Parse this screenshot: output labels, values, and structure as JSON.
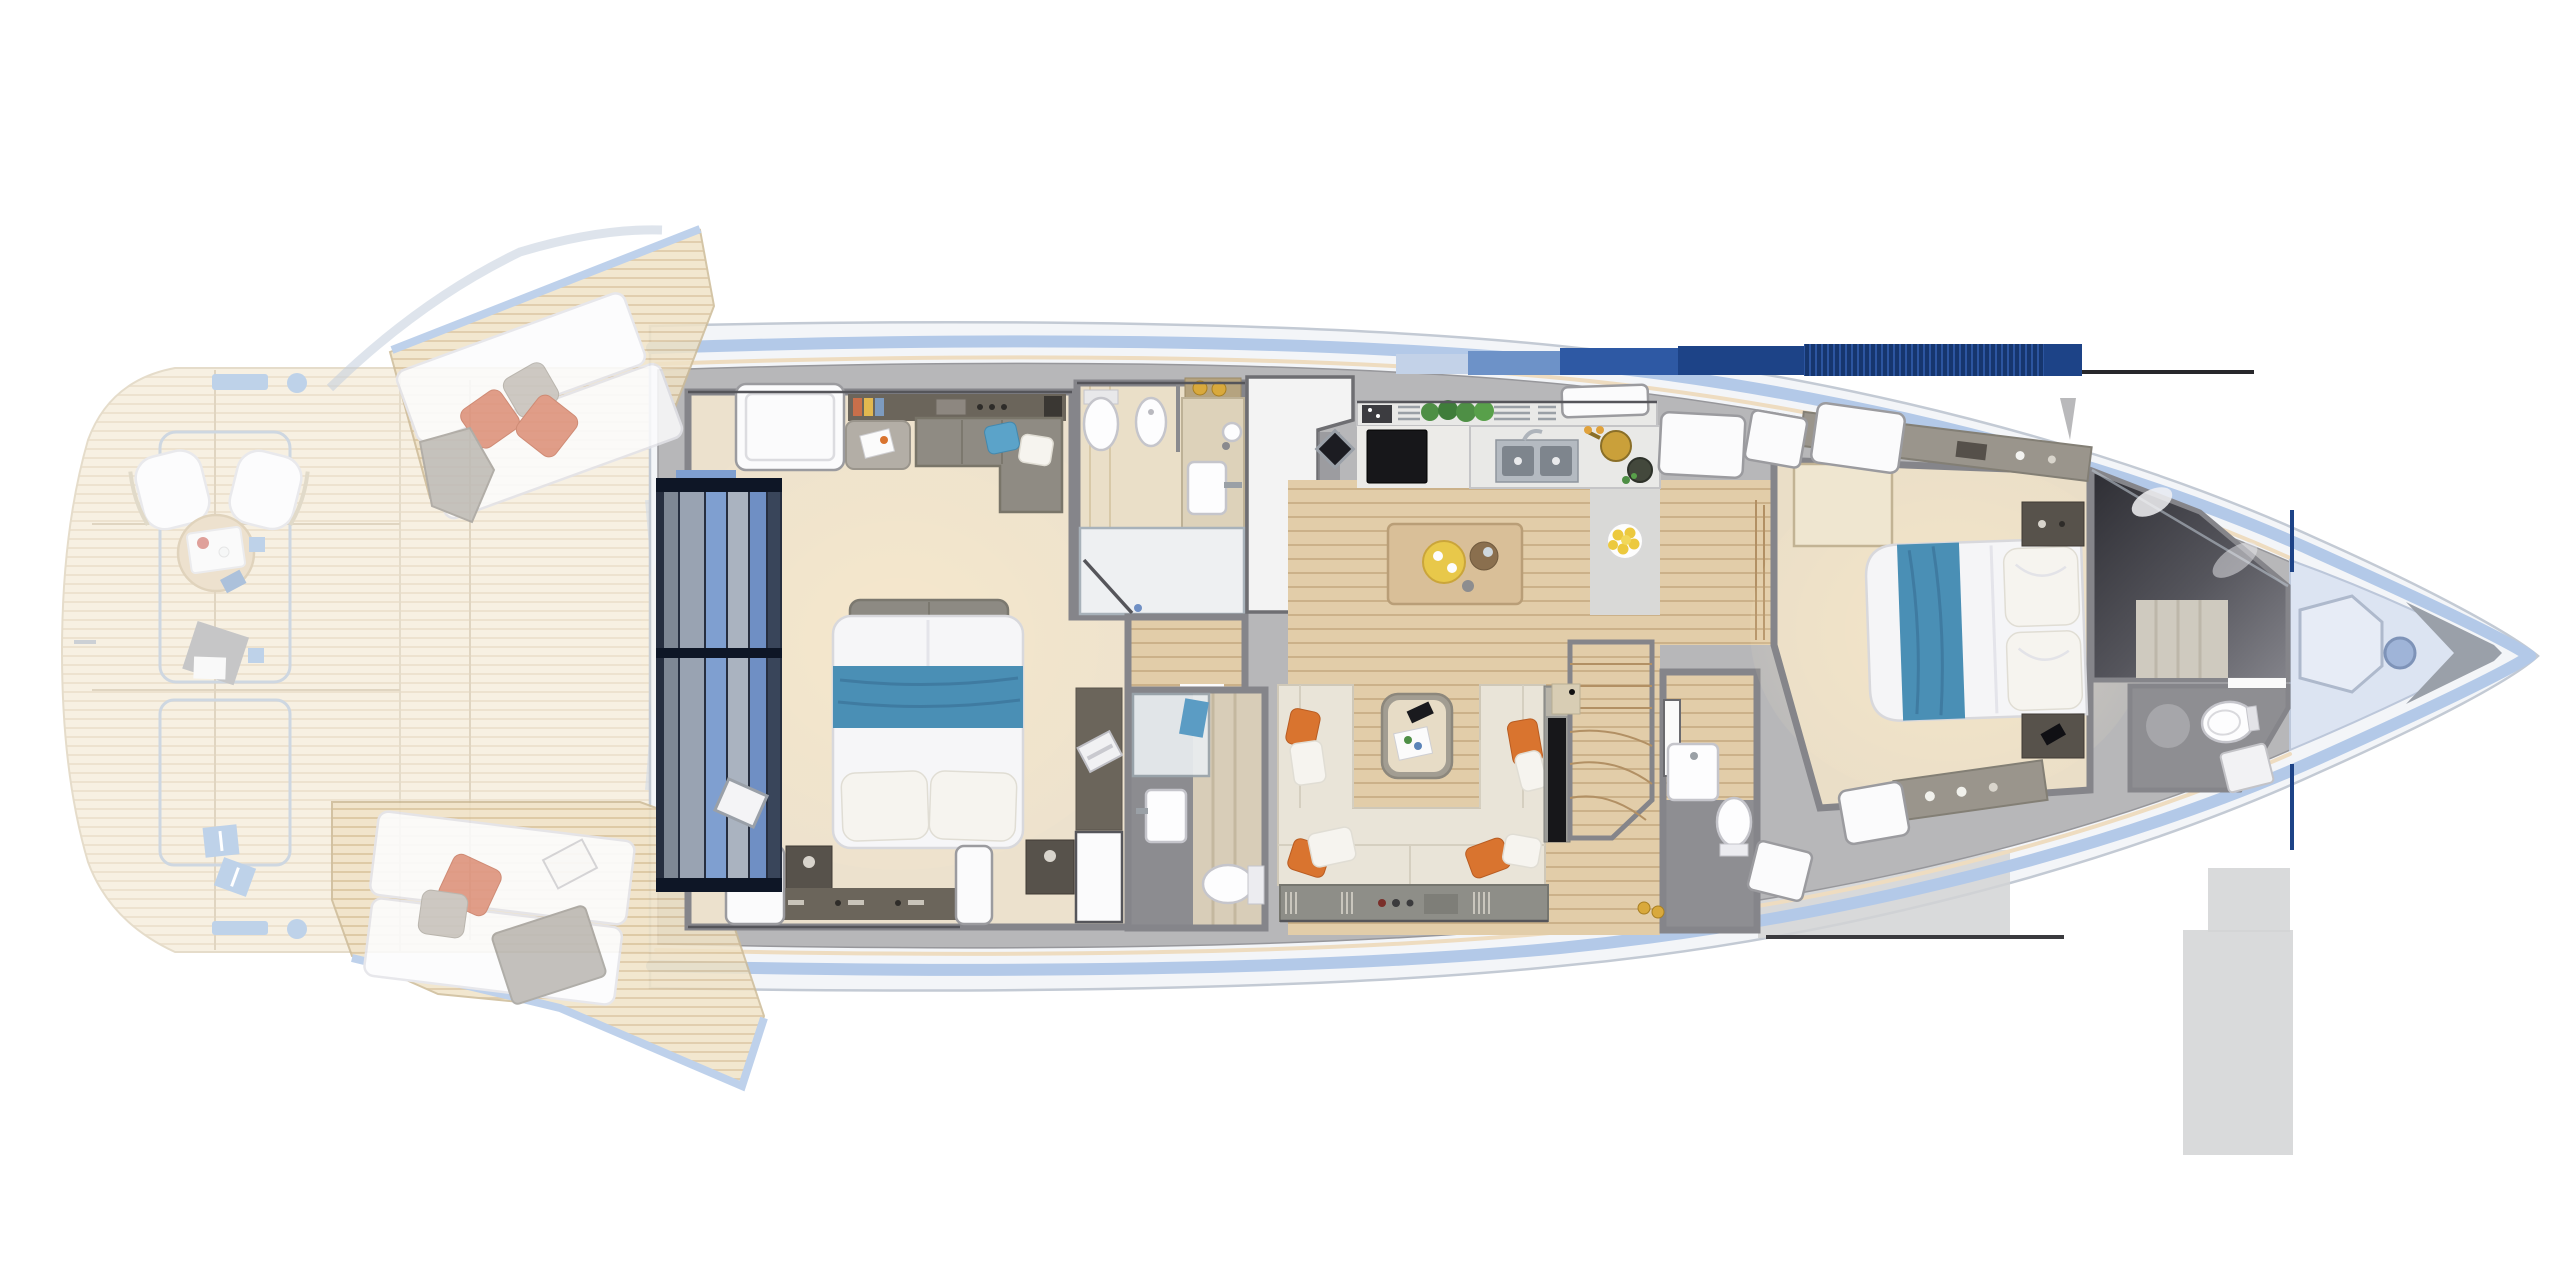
{
  "title": "Motor yacht deck plan — top-down interior rendering (no visible text in image)",
  "palette": {
    "hull": "#f3f5f8",
    "hullEdge": "#c3cad4",
    "stripe": "#b3c9e8",
    "warmLine": "#eedcc0",
    "deckGray": "#b7b7b9",
    "wallMid": "#85858a",
    "wallDark": "#55555a",
    "teak": "#f0e3c7",
    "teakLine": "#dcc6a0",
    "teakEdge": "#cdbb97",
    "wood": "#e2cda9",
    "woodLine": "#cbb189",
    "floorCream": "#ece1cd",
    "floorBath": "#eadfc8",
    "floorGrayDark": "#8e8e92",
    "floorGrayLight": "#d9d9d7",
    "navy": "#1d4387",
    "navyDark": "#16366e",
    "navyMid": "#2c55a0",
    "blueMid": "#6d92c8",
    "blueLight": "#c3d2e8",
    "accentBlue": "#7fa6d4",
    "bedBlue": "#4a8fb5",
    "bedBlueDark": "#3f7ba1",
    "pillowCoral": "#dd8f79",
    "pillowOrange": "#d9742f",
    "pillowGray": "#c6c2bd",
    "sofaCream": "#e9e4d8",
    "sofaGray": "#8f8b83",
    "counter": "#e9e9e7",
    "steel": "#b4bac1",
    "tvBlack": "#17171a",
    "plant": "#4e8f45",
    "lemon": "#ecc93e",
    "gold": "#d9a93c",
    "darkWood": "#6b655b",
    "nightstand": "#57524b",
    "glow": "#ffefc9",
    "shadow": "#d2d3d5",
    "anchor": "#9aa0a9",
    "bowDeck": "#dce4f2",
    "darkRoom": "#3c3c42",
    "doorFrame": "#0e1626",
    "doorBlue": "#7f9fd0"
  },
  "regions": {
    "aft_deck": {
      "name": "aft deck and swim platform (shown faded / folded-down terraces)",
      "items": [
        "curved swim platform",
        "teak decking",
        "deck chair x2",
        "round service table with tray",
        "folded gray towel",
        "mooring cleat strip x2",
        "mooring bollard x2",
        "blue fender box x2",
        "deck seam outlines"
      ]
    },
    "port_wing": {
      "name": "port fold-out bulwark terrace",
      "items": [
        "teak wedge deck",
        "double sun pad",
        "coral pillow x2",
        "gray pillow",
        "gray throw blanket"
      ]
    },
    "starboard_wing": {
      "name": "starboard fold-out bulwark terrace",
      "items": [
        "teak wedge deck",
        "double sun pad",
        "coral pillow",
        "gray pillow",
        "gray beach towel",
        "open magazine"
      ]
    },
    "master_cabin": {
      "name": "full-beam master cabin",
      "items": [
        "aft glass door with navy frame",
        "skylight hatch",
        "double bed with blue runner and two pillows",
        "foot bench",
        "L-shaped sofa with blue pillow",
        "side table with magazine",
        "aft cabinet with lamps",
        "nightstand x2",
        "vanity desk with laptop",
        "white cabin door",
        "hull window hatch x2"
      ]
    },
    "master_bathroom": {
      "name": "master bathroom",
      "items": [
        "toilet",
        "bidet",
        "vanity counter with basin",
        "round sink",
        "amber bottles x2",
        "shower with glass door"
      ]
    },
    "hallway": {
      "name": "lower hallway",
      "items": [
        "wood floor",
        "door gap to guest bathroom"
      ]
    },
    "guest_bathroom": {
      "name": "guest shower room",
      "items": [
        "glass shower with blue towel",
        "washbasin",
        "toilet",
        "tiled wall"
      ]
    },
    "stair_block": {
      "name": "companionway block (white)",
      "items": [
        "white stair enclosure",
        "black deck speaker"
      ]
    },
    "galley": {
      "name": "galley",
      "items": [
        "aft counter with vent grilles",
        "herb plants x4",
        "wall TV",
        "double stainless sink with faucet",
        "cooktop with pan and pot",
        "plate of lemons",
        "deck hatch x2"
      ]
    },
    "dining": {
      "name": "dining area",
      "items": [
        "wood plank floor",
        "island table",
        "yellow serving tray",
        "wooden charger plate",
        "small bowl"
      ]
    },
    "salon": {
      "name": "salon",
      "items": [
        "U-shaped cream sofa",
        "orange pillow x4",
        "cream pillow x4",
        "coffee table with magazine and phone",
        "wall TV column",
        "under-sofa cabinet with vents"
      ]
    },
    "stairwell": {
      "name": "stairs down",
      "items": [
        "wooden treads",
        "curved lower steps",
        "corner cabinet"
      ]
    },
    "day_head": {
      "name": "day head",
      "items": [
        "white door",
        "washbasin",
        "toilet",
        "amber bottles x2",
        "deck hatch"
      ]
    },
    "forward_corridor": {
      "name": "steps to forward cabin",
      "items": [
        "wood steps"
      ]
    },
    "forward_cabin": {
      "name": "forward VIP cabin",
      "items": [
        "double bed with blue runner",
        "stacked pillows x2",
        "nightstand with phone",
        "nightstand with tray",
        "overhead cabinet band with lights",
        "dresser",
        "deck hatch x4"
      ]
    },
    "forward_bathroom": {
      "name": "forward en-suite",
      "items": [
        "dark glass shower room",
        "tiled shower wall",
        "white towel",
        "toilet",
        "shower tray",
        "door gap"
      ]
    },
    "bow_deck": {
      "name": "bow deck",
      "items": [
        "hexagonal deck hatch",
        "windlass",
        "anchor fairlead at stem"
      ]
    },
    "hull": {
      "name": "hull and superstructure",
      "features": [
        "white hull with light-blue sheer stripe",
        "warm caulking line",
        "gray side-deck band",
        "navy hardtop band (striped) top right",
        "thin black datum line x2",
        "navy fold lines at bow bulwark",
        "antenna fin",
        "render shadow blocks",
        "trim-tab mark far left"
      ]
    }
  }
}
